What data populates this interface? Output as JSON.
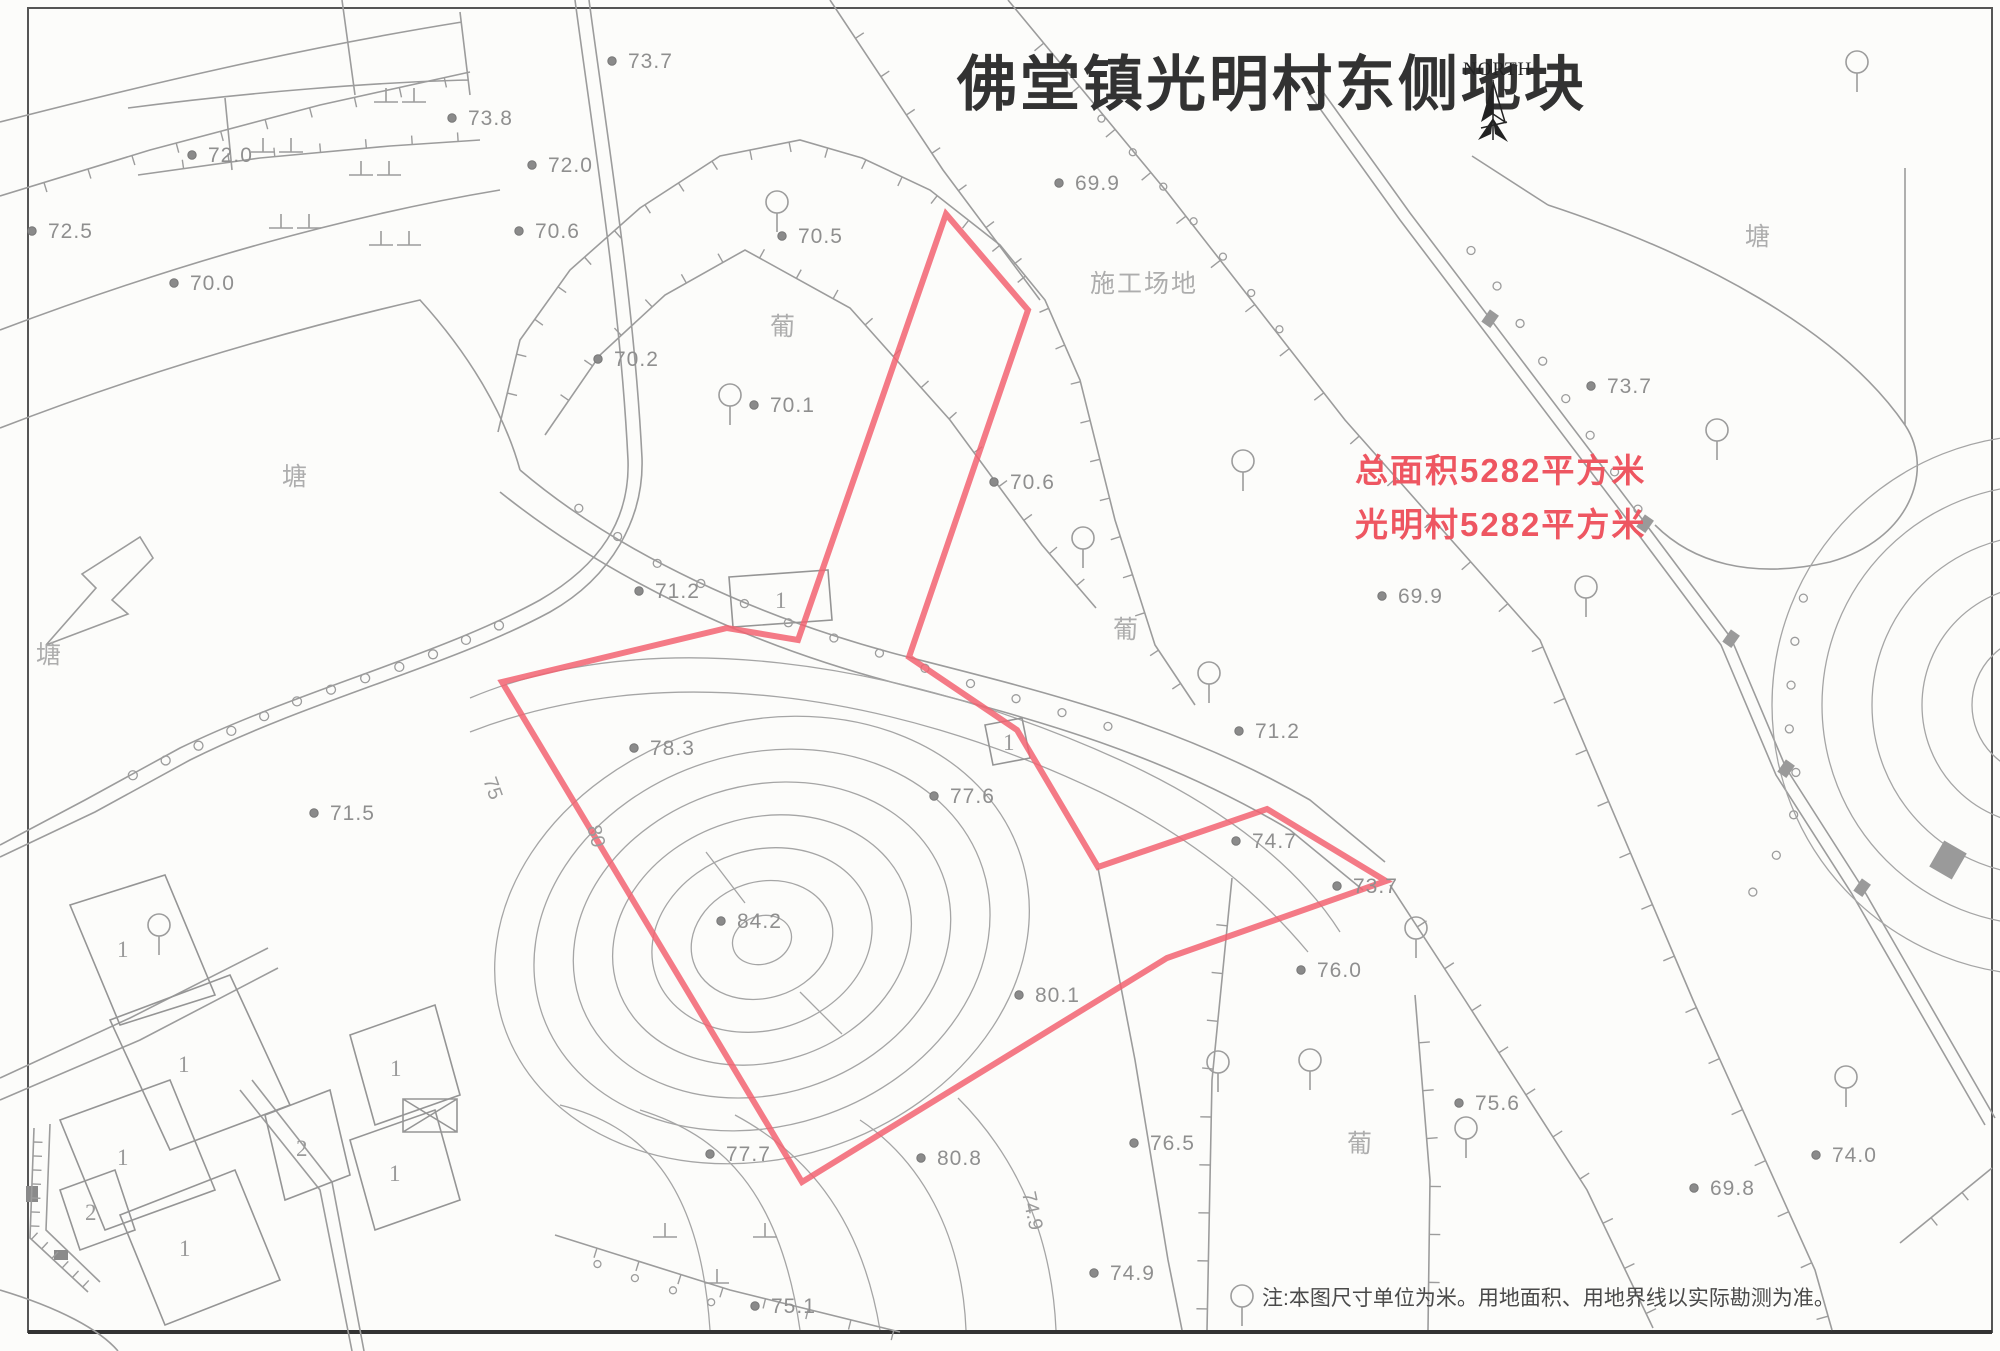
{
  "title": "佛堂镇光明村东侧地块",
  "north": {
    "label": "NORTH"
  },
  "annotations": {
    "area_line1": "总面积5282平方米",
    "area_line2": "光明村5282平方米",
    "note": "注:本图尺寸单位为米。用地面积、用地界线以实际勘测为准。"
  },
  "colors": {
    "parcel_outline": "#f26371",
    "red_text": "#ee5661",
    "linework": "#9c9c9c",
    "spot_label": "#8f8f8f",
    "title_text": "#323232"
  },
  "parcel": {
    "vertices": [
      [
        946,
        214
      ],
      [
        1028,
        310
      ],
      [
        909,
        657
      ],
      [
        1017,
        730
      ],
      [
        1098,
        867
      ],
      [
        1267,
        809
      ],
      [
        1386,
        881
      ],
      [
        1167,
        958
      ],
      [
        802,
        1182
      ],
      [
        502,
        682
      ],
      [
        727,
        628
      ],
      [
        798,
        640
      ]
    ]
  },
  "spot_elevations": [
    {
      "v": "73.7",
      "x": 628,
      "y": 68
    },
    {
      "v": "73.8",
      "x": 468,
      "y": 125
    },
    {
      "v": "72.0",
      "x": 208,
      "y": 162
    },
    {
      "v": "72.0",
      "x": 548,
      "y": 172
    },
    {
      "v": "70.6",
      "x": 535,
      "y": 238
    },
    {
      "v": "72.5",
      "x": 48,
      "y": 238
    },
    {
      "v": "70.0",
      "x": 190,
      "y": 290
    },
    {
      "v": "70.5",
      "x": 798,
      "y": 243
    },
    {
      "v": "69.9",
      "x": 1075,
      "y": 190
    },
    {
      "v": "70.2",
      "x": 614,
      "y": 366
    },
    {
      "v": "70.1",
      "x": 770,
      "y": 412
    },
    {
      "v": "70.6",
      "x": 1010,
      "y": 489
    },
    {
      "v": "69.9",
      "x": 1398,
      "y": 603
    },
    {
      "v": "71.2",
      "x": 655,
      "y": 598
    },
    {
      "v": "71.2",
      "x": 1255,
      "y": 738
    },
    {
      "v": "78.3",
      "x": 650,
      "y": 755
    },
    {
      "v": "71.5",
      "x": 330,
      "y": 820
    },
    {
      "v": "77.6",
      "x": 950,
      "y": 803
    },
    {
      "v": "74.7",
      "x": 1252,
      "y": 848
    },
    {
      "v": "73.7",
      "x": 1353,
      "y": 893
    },
    {
      "v": "84.2",
      "x": 737,
      "y": 928
    },
    {
      "v": "76.0",
      "x": 1317,
      "y": 977
    },
    {
      "v": "80.1",
      "x": 1035,
      "y": 1002
    },
    {
      "v": "80.8",
      "x": 937,
      "y": 1165
    },
    {
      "v": "77.7",
      "x": 726,
      "y": 1161
    },
    {
      "v": "76.5",
      "x": 1150,
      "y": 1150
    },
    {
      "v": "75.6",
      "x": 1475,
      "y": 1110
    },
    {
      "v": "74.0",
      "x": 1832,
      "y": 1162
    },
    {
      "v": "69.8",
      "x": 1710,
      "y": 1195
    },
    {
      "v": "74.9",
      "x": 1110,
      "y": 1280
    },
    {
      "v": "75.1",
      "x": 771,
      "y": 1313
    },
    {
      "v": "73.7",
      "x": 1607,
      "y": 393
    }
  ],
  "rotated_labels": [
    {
      "v": "74.9",
      "x": 1022,
      "y": 1193,
      "rot": 78
    },
    {
      "v": "80",
      "x": 587,
      "y": 827,
      "rot": 75
    },
    {
      "v": "75",
      "x": 483,
      "y": 780,
      "rot": 70
    }
  ],
  "land_labels": [
    {
      "t": "塘",
      "x": 282,
      "y": 485
    },
    {
      "t": "塘",
      "x": 36,
      "y": 663
    },
    {
      "t": "塘",
      "x": 1745,
      "y": 245
    },
    {
      "t": "施工场地",
      "x": 1090,
      "y": 292
    },
    {
      "t": "葡",
      "x": 770,
      "y": 335
    },
    {
      "t": "葡",
      "x": 1113,
      "y": 638
    },
    {
      "t": "葡",
      "x": 1347,
      "y": 1152
    }
  ],
  "building_labels": [
    {
      "t": "1",
      "x": 117,
      "y": 957
    },
    {
      "t": "1",
      "x": 178,
      "y": 1072
    },
    {
      "t": "1",
      "x": 117,
      "y": 1165
    },
    {
      "t": "2",
      "x": 85,
      "y": 1220
    },
    {
      "t": "1",
      "x": 179,
      "y": 1256
    },
    {
      "t": "2",
      "x": 296,
      "y": 1156
    },
    {
      "t": "1",
      "x": 390,
      "y": 1076
    },
    {
      "t": "1",
      "x": 389,
      "y": 1181
    },
    {
      "t": "1",
      "x": 775,
      "y": 608
    },
    {
      "t": "1",
      "x": 1003,
      "y": 750
    }
  ],
  "trees": [
    [
      777,
      202
    ],
    [
      730,
      395
    ],
    [
      1083,
      538
    ],
    [
      1209,
      673
    ],
    [
      1717,
      430
    ],
    [
      1857,
      62
    ],
    [
      1243,
      461
    ],
    [
      1218,
      1062
    ],
    [
      1310,
      1060
    ],
    [
      1466,
      1128
    ],
    [
      1846,
      1077
    ],
    [
      1586,
      587
    ],
    [
      1416,
      928
    ],
    [
      159,
      925
    ],
    [
      1242,
      1296
    ]
  ]
}
